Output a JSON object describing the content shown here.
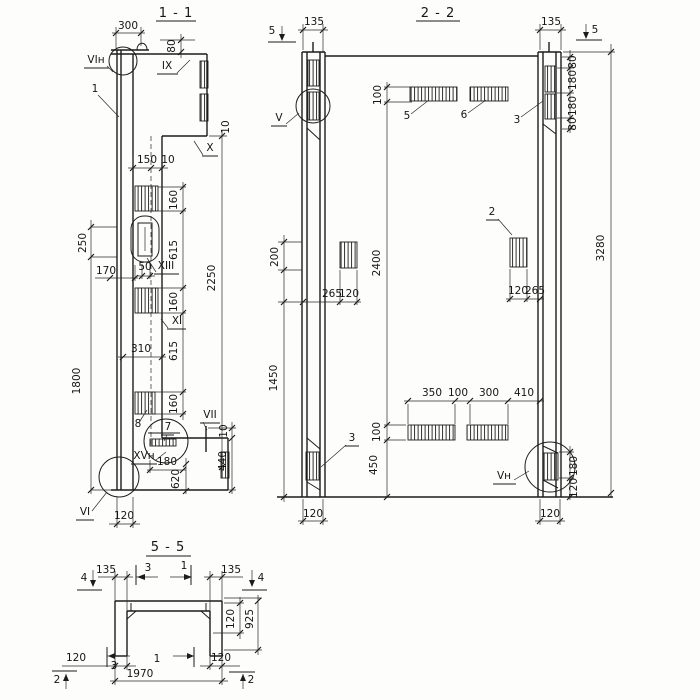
{
  "s11": {
    "title": "1 - 1",
    "d300": "300",
    "d80": "80",
    "lab_vi_n": "VIн",
    "lab_1": "1",
    "lab_ix": "IX",
    "d10a": "10",
    "lab_x": "X",
    "d150": "150",
    "d10b": "10",
    "d160a": "160",
    "d615a": "615",
    "d2250": "2250",
    "lab_xiii": "XIII",
    "d50": "50",
    "d170": "170",
    "d160b": "160",
    "lab_xi": "XI",
    "d250": "250",
    "d1800": "1800",
    "d310": "310",
    "d615b": "615",
    "d160c": "160",
    "lab_8": "8",
    "lab_7": "7",
    "lab_vii": "VII",
    "d10c": "10",
    "lab_xv_n": "XVн",
    "d180": "180",
    "d620": "620",
    "d440": "440",
    "lab_vi": "VI",
    "d120": "120"
  },
  "s22": {
    "title": "2 - 2",
    "marker5l": "5",
    "d135l": "135",
    "lab_v": "V",
    "d100a": "100",
    "lab_5": "5",
    "lab_6": "6",
    "lab_3a": "3",
    "d135r": "135",
    "marker5r": "5",
    "d80a": "80",
    "d180a": "180",
    "d180b": "180",
    "d80b": "80",
    "d200": "200",
    "d2400": "2400",
    "d265a": "265",
    "d120a": "120",
    "lab_2": "2",
    "d3280": "3280",
    "d120b": "120",
    "d265b": "265",
    "d1450": "1450",
    "lab_3b": "3",
    "d350": "350",
    "d100b": "100",
    "d300": "300",
    "d410": "410",
    "d100c": "100",
    "d450": "450",
    "lab_v_n": "Vн",
    "d180c": "180",
    "d120c": "120",
    "d120e": "120",
    "d120f": "120"
  },
  "s55": {
    "title": "5 - 5",
    "marker4l": "4",
    "d135l": "135",
    "marker3t": "3",
    "marker1t": "1",
    "d135r": "135",
    "marker4r": "4",
    "d120a": "120",
    "d925": "925",
    "d120b": "120",
    "marker3b": "3",
    "marker1b": "1",
    "d120c": "120",
    "d1970": "1970",
    "marker2l": "2",
    "marker2r": "2"
  }
}
